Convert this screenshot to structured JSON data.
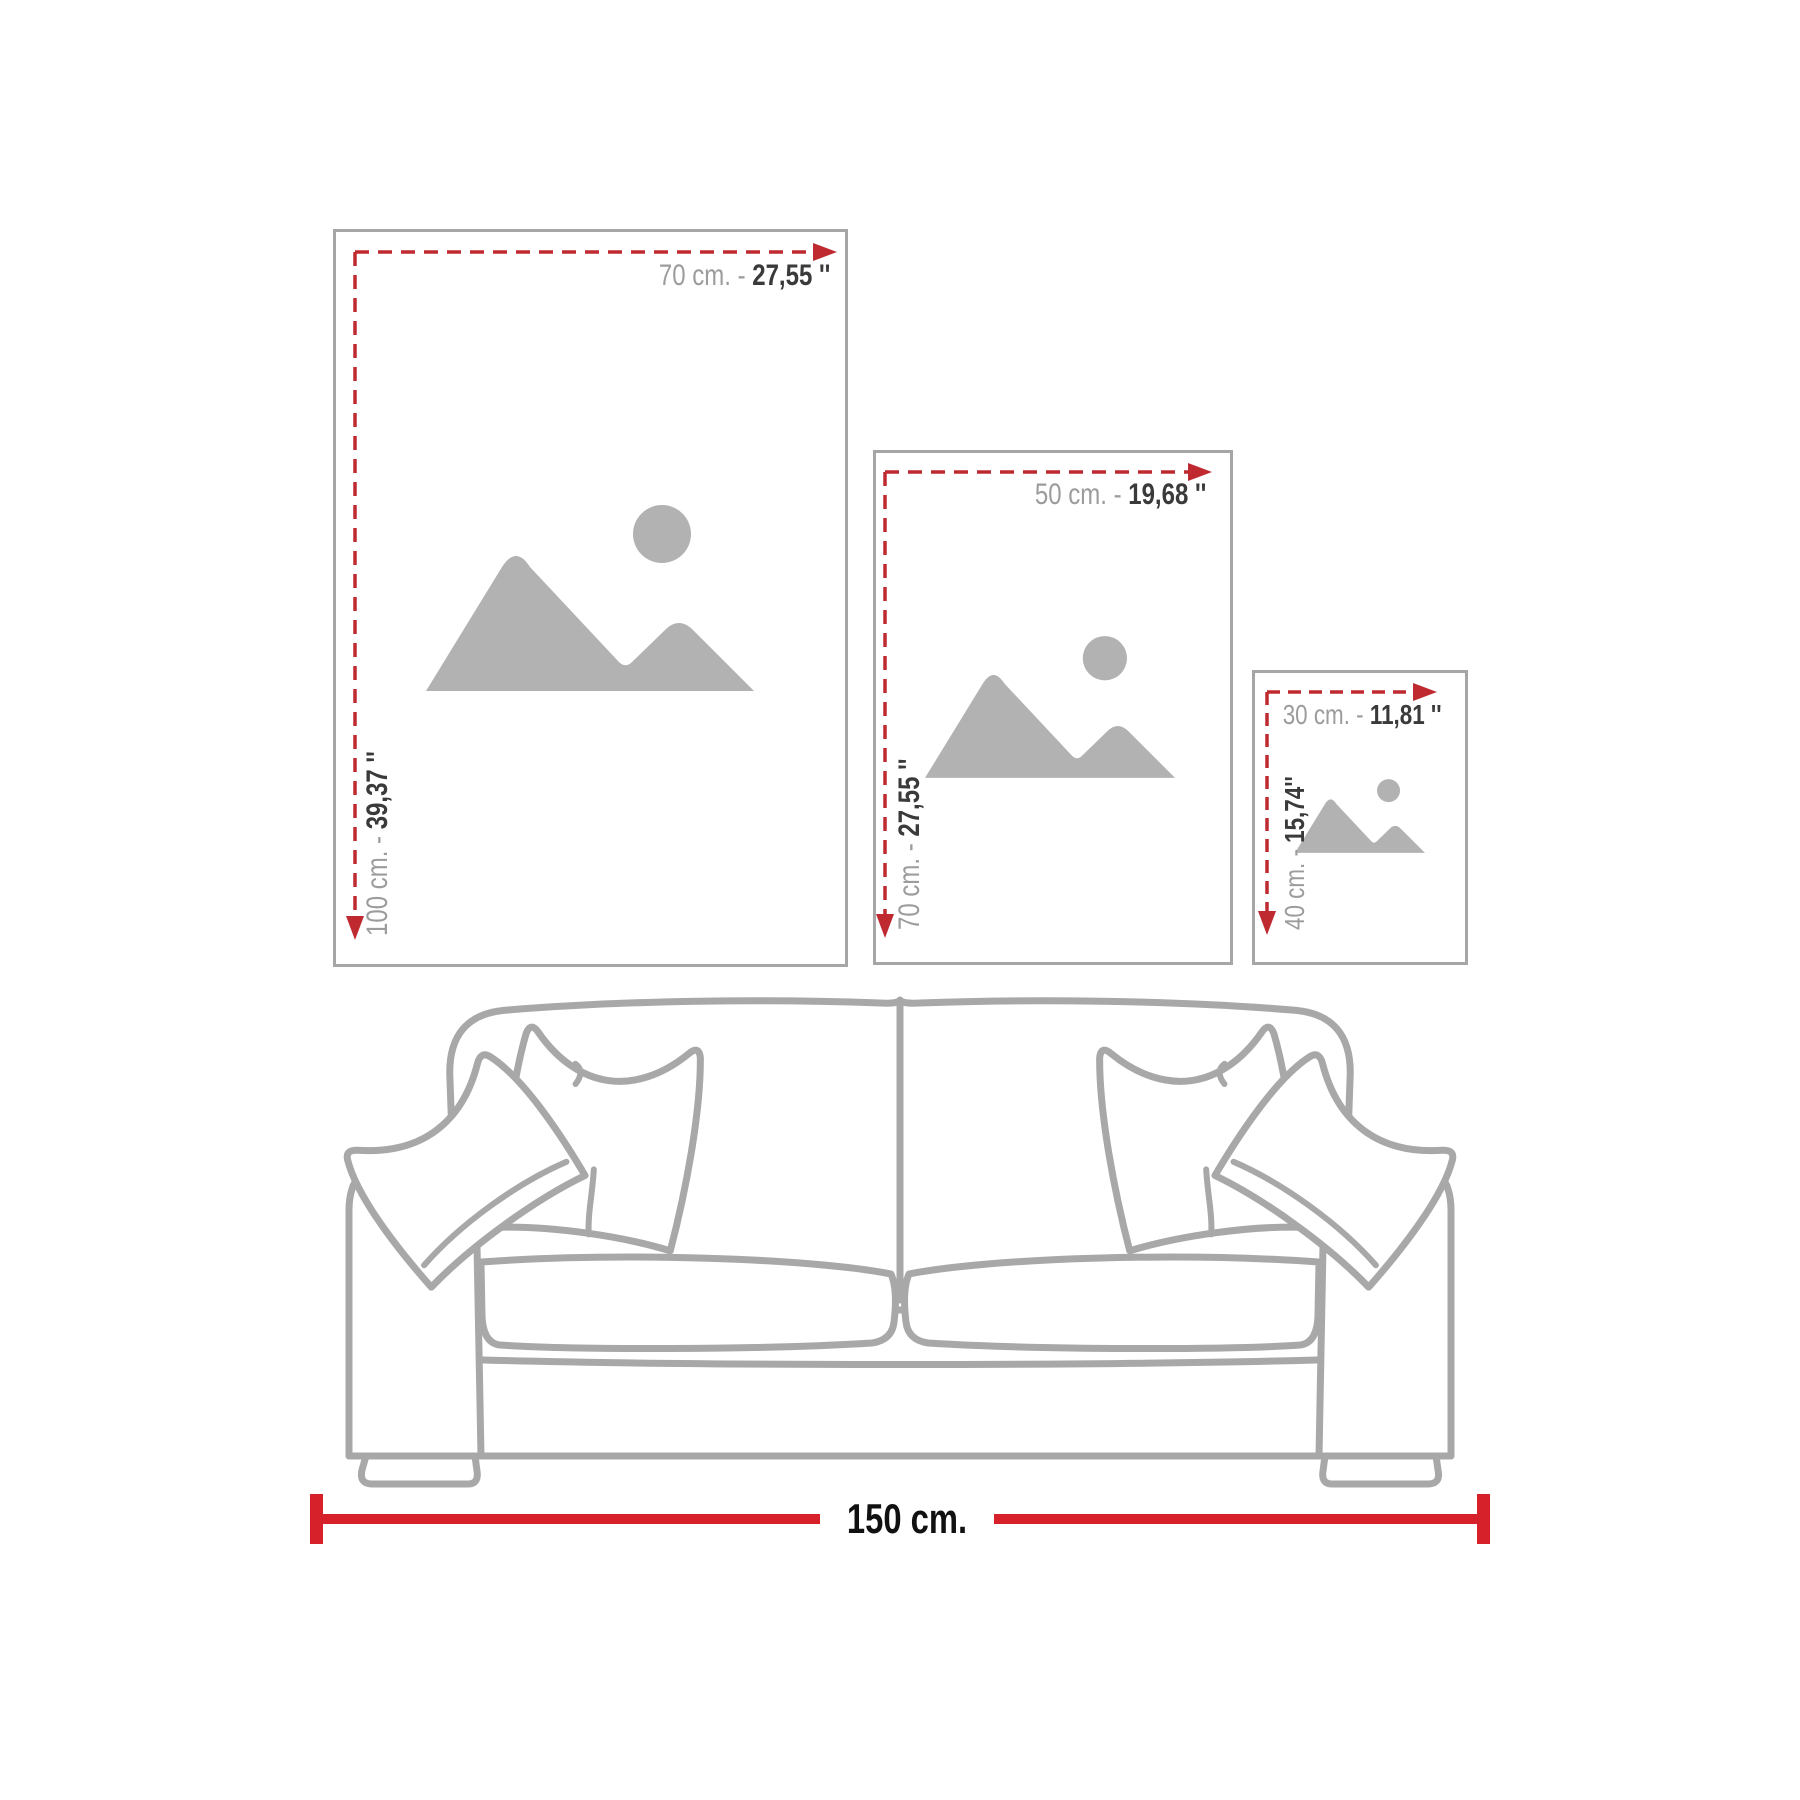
{
  "title": "Wall art size guide above sofa",
  "colors": {
    "measure_dash_red": "#bf2a31",
    "ruler_red": "#d6202a",
    "frame_border_gray": "#a6a6a6",
    "placeholder_gray": "#b2b2b2",
    "label_gray": "#9c9c9c",
    "label_dark": "#3a3a3a",
    "sofa_line_gray": "#a8a8a8",
    "ruler_text": "#111111"
  },
  "frames": [
    {
      "name": "frame-70x100",
      "width_label": {
        "cm": "70 cm. - ",
        "inch": "27,55 ''"
      },
      "height_label": {
        "cm": "100 cm. - ",
        "inch": "39,37 ''"
      }
    },
    {
      "name": "frame-50x70",
      "width_label": {
        "cm": "50 cm. - ",
        "inch": "19,68 ''"
      },
      "height_label": {
        "cm": "70 cm. - ",
        "inch": "27,55 ''"
      }
    },
    {
      "name": "frame-30x40",
      "width_label": {
        "cm": "30 cm. - ",
        "inch": "11,81 ''"
      },
      "height_label": {
        "cm": "40 cm. - ",
        "inch": "15,74''"
      }
    }
  ],
  "ruler": {
    "label": "150 cm."
  },
  "icons": [
    {
      "name": "image-placeholder-icon",
      "description": "mountains with sun"
    }
  ]
}
